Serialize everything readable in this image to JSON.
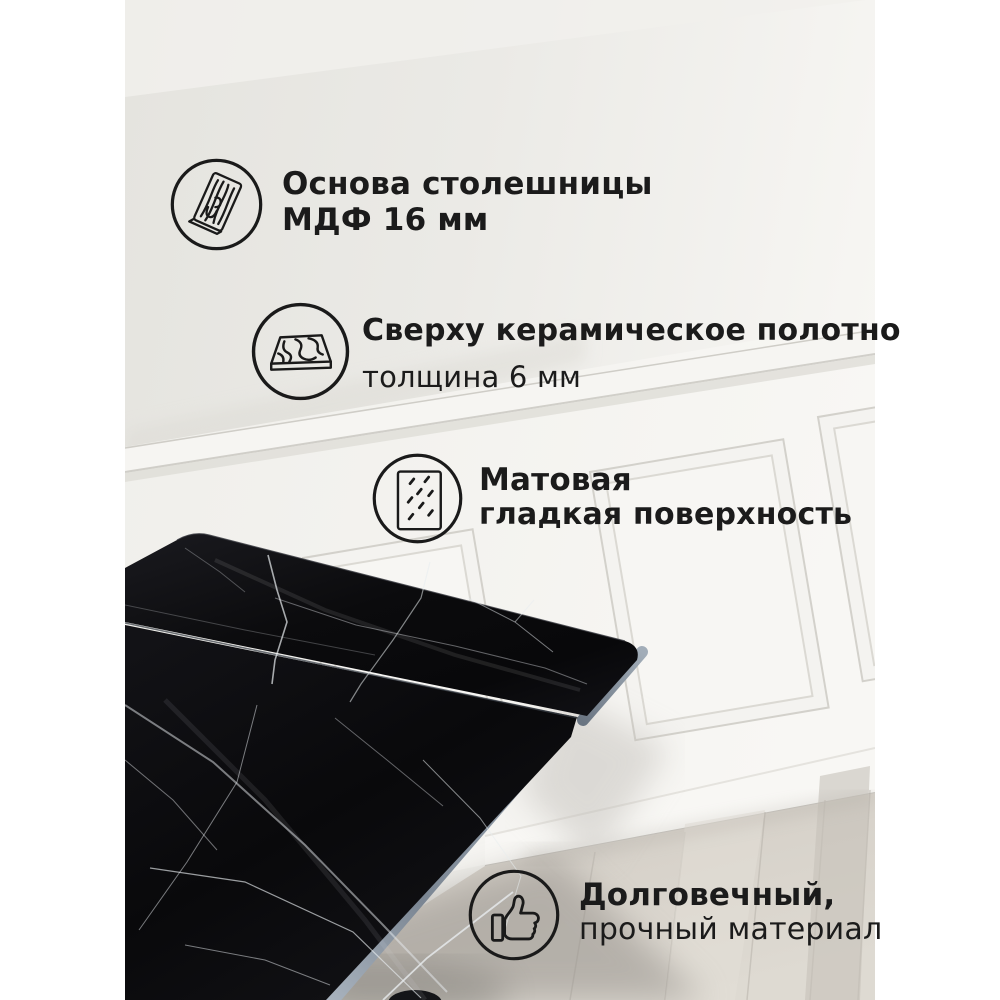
{
  "colors": {
    "canvas": "#ffffff",
    "text": "#1b1b1b",
    "icon_stroke": "#1a1a1a",
    "wall": "#e8e7e2",
    "wainscot": "#f6f5f2",
    "marble": "#0b0b0d",
    "marble_vein": "#e8ecef",
    "slab_edge": "#8d99a6",
    "floor": "#d5d0c8"
  },
  "features": [
    {
      "icon": "mdf-board-icon",
      "line1": "Основа столешницы",
      "line2": "МДФ 16 мм"
    },
    {
      "icon": "ceramic-slab-icon",
      "line1": "Сверху керамическое полотно",
      "line2": "толщина 6 мм"
    },
    {
      "icon": "matte-surface-icon",
      "line1": "Матовая",
      "line2": "гладкая поверхность"
    },
    {
      "icon": "thumbs-up-icon",
      "line1": "Долговечный,",
      "line2": "прочный материал"
    }
  ],
  "scene": {
    "subject": "черная мраморная керамическая столешница",
    "setting": "белая стена с молдингами и светлый деревянный пол"
  }
}
